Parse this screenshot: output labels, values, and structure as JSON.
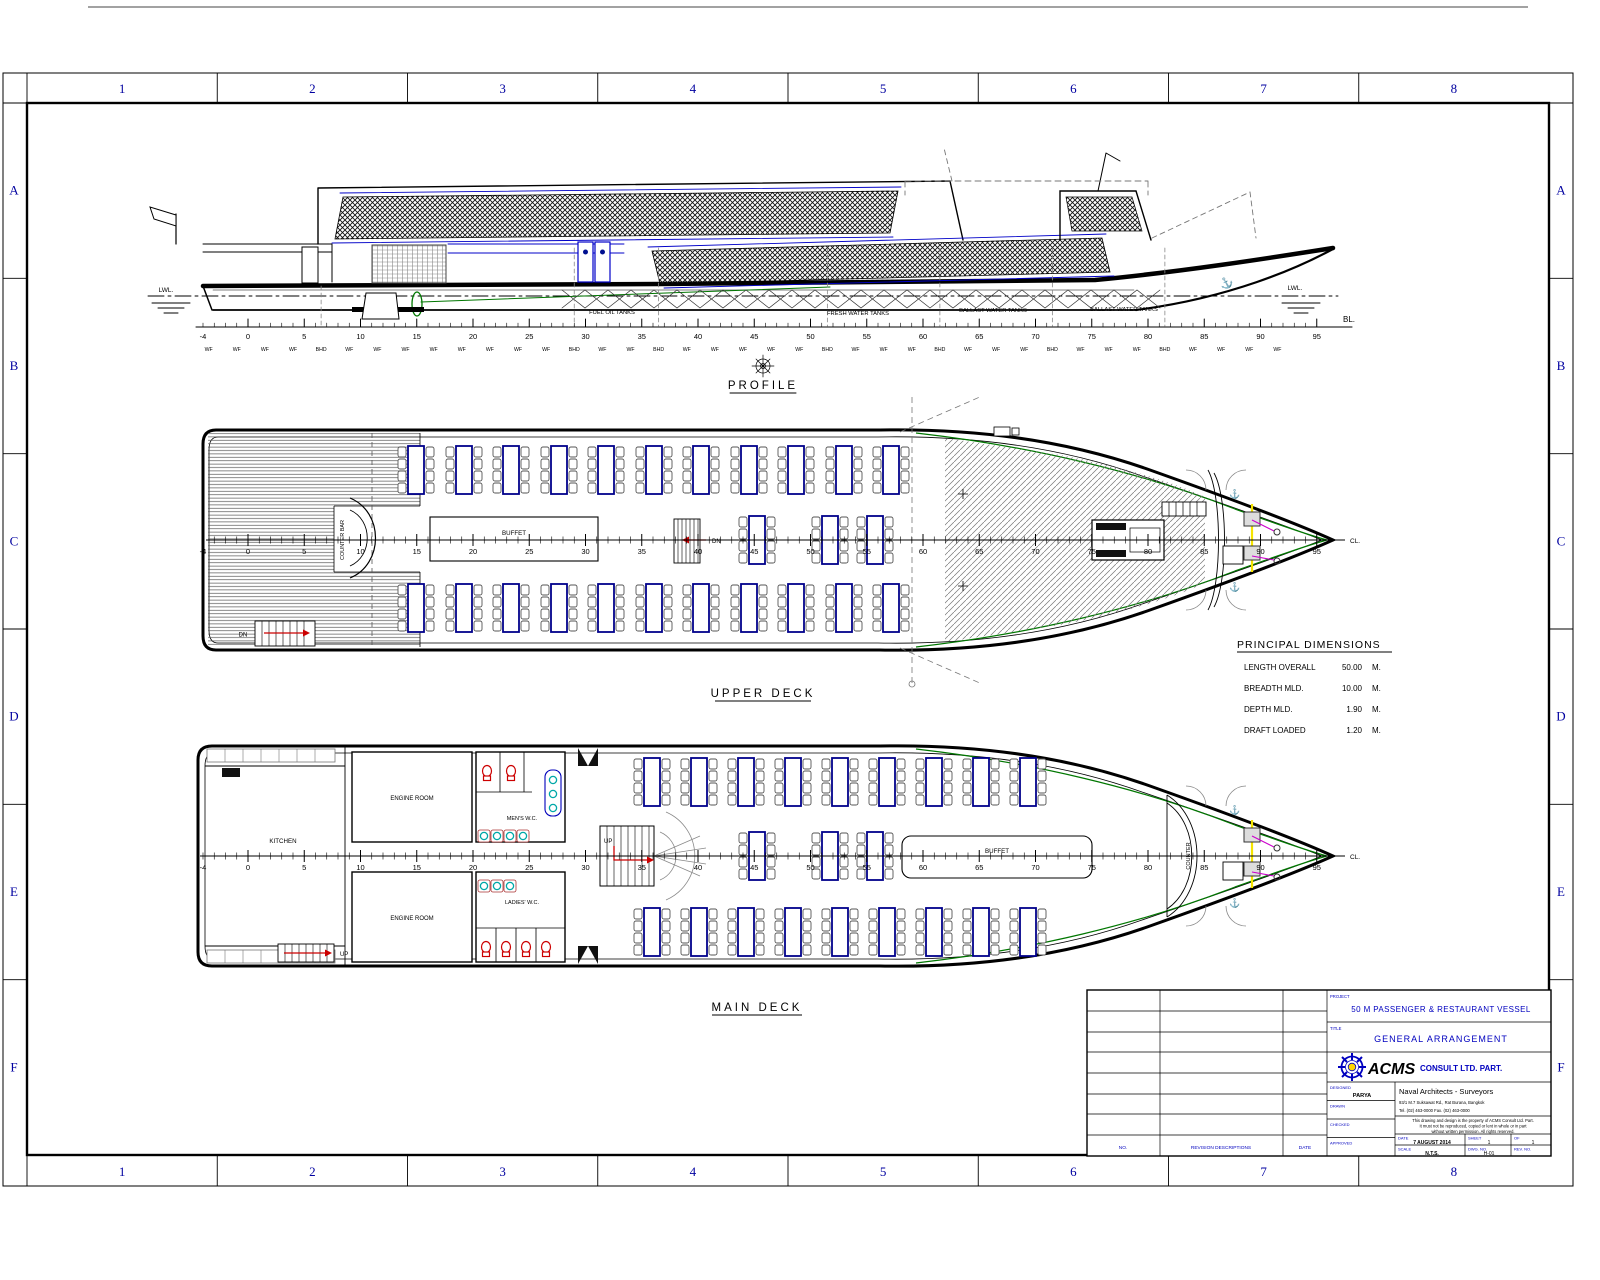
{
  "sheet": {
    "grid_cols": [
      "1",
      "2",
      "3",
      "4",
      "5",
      "6",
      "7",
      "8"
    ],
    "grid_rows": [
      "A",
      "B",
      "C",
      "D",
      "E",
      "F"
    ],
    "accent_blue": "#0000bf"
  },
  "icons": {
    "anchor": "⚓"
  },
  "views": {
    "profile": {
      "label": "PROFILE",
      "lwl_left": "LWL.",
      "lwl_right": "LWL.",
      "bl": "BL.",
      "tanks": [
        "FUEL OIL TANKS",
        "FRESH WATER TANKS",
        "BALLAST WATER TANKS",
        "BALLAST WATER TANKS"
      ]
    },
    "upper_deck": {
      "label": "UPPER DECK",
      "counter_bar": "COUNTER BAR",
      "buffet": "BUFFET",
      "dn_mid": "DN",
      "dn_aft": "DN",
      "cl": "CL."
    },
    "main_deck": {
      "label": "MAIN DECK",
      "kitchen": "KITCHEN",
      "engine_room": "ENGINE ROOM",
      "mens_wc": "MEN'S W.C.",
      "ladies_wc": "LADIES' W.C.",
      "buffet": "BUFFET",
      "counter": "COUNTER",
      "up_mid": "UP",
      "up_aft": "UP",
      "cl": "CL."
    }
  },
  "ruler": {
    "x0": 248,
    "ppf": 11.25,
    "start": -4,
    "end": 95,
    "label_step": 5,
    "wf_label": "WF",
    "bhd_label": "BHD",
    "bhd_frames": [
      6.5,
      29,
      36.5,
      51.5,
      61.5,
      71.5,
      81.5
    ],
    "wf_step": 2.5
  },
  "principal_dimensions": {
    "title": "PRINCIPAL DIMENSIONS",
    "rows": [
      {
        "name": "LENGTH OVERALL",
        "value": "50.00",
        "unit": "M."
      },
      {
        "name": "BREADTH MLD.",
        "value": "10.00",
        "unit": "M."
      },
      {
        "name": "DEPTH  MLD.",
        "value": "1.90",
        "unit": "M."
      },
      {
        "name": "DRAFT LOADED",
        "value": "1.20",
        "unit": "M."
      }
    ]
  },
  "title_block": {
    "project_label": "PROJECT",
    "project": "50 M PASSENGER & RESTAURANT VESSEL",
    "title_label": "TITLE",
    "title": "GENERAL ARRANGEMENT",
    "company_logo_text": "ACMS",
    "company": "CONSULT LTD. PART.",
    "designed_label": "DESIGNED",
    "designed": "PARYA",
    "drawn_label": "DRAWN",
    "drawn": "",
    "checked_label": "CHECKED",
    "checked": "",
    "approved_label": "APPROVED",
    "approved": "",
    "firm_line1": "Naval Architects - Surveyors",
    "firm_line2": "93/1 M.7 Suksawat Rd., Rat Burana, Bangkok",
    "firm_line3": "Tel. (02) 463-0000   Fax. (02) 463-0000",
    "note_line1": "This drawing and design is the property of ACMS Consult Ltd. Part.",
    "note_line2": "It must not be reproduced, copied or lent in whole or in part",
    "note_line3": "without written permission. All rights reserved.",
    "date_label": "DATE",
    "date": "7 AUGUST 2014",
    "sheet_label": "SHEET",
    "sheet": "1",
    "of_label": "OF",
    "of": "1",
    "scale_label": "SCALE",
    "scale": "N.T.S.",
    "dwg_label": "DWG. NO.",
    "dwg": "H-01",
    "rev_label": "REV. NO.",
    "rev": "",
    "rev_table": {
      "no": "NO.",
      "desc": "REVISION DESCRIPTIONS",
      "date": "DATE"
    }
  }
}
